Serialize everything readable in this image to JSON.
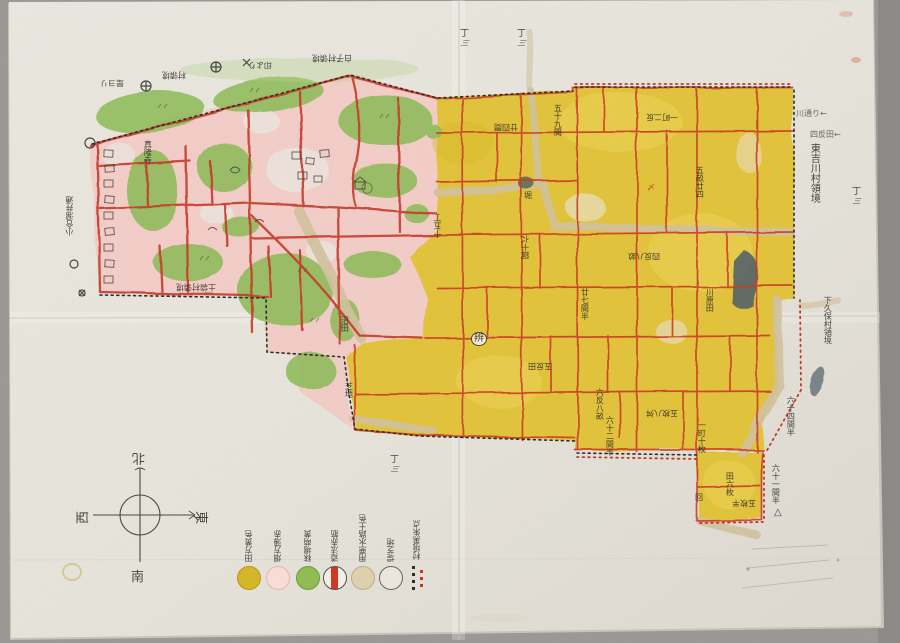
{
  "compass": {
    "north": "北",
    "south": "南",
    "east": "東",
    "west": "西"
  },
  "measure_mark": {
    "top": "丁",
    "bottom": "三"
  },
  "legend": {
    "entries": [
      {
        "name": "rice-field",
        "label": "田方黄色",
        "color": "#d4b62a"
      },
      {
        "name": "upland-field",
        "label": "畑方薄赤",
        "color": "#f7ddd6"
      },
      {
        "name": "meadow",
        "label": "秣場萌黄",
        "color": "#8fbc55"
      },
      {
        "name": "road",
        "label": "道法赤筋",
        "color": "#cf3a22"
      },
      {
        "name": "waterway",
        "label": "用悪水路土色",
        "color": "#ddd0ac"
      },
      {
        "name": "levee-grass",
        "label": "堤芝地",
        "color": "#f2efe7"
      },
      {
        "name": "boundary-marks",
        "label": "村境黒朱点",
        "colors": [
          "#2f2d28",
          "#c23a22"
        ]
      }
    ]
  },
  "labels": [
    {
      "text": "是ヨリ"
    },
    {
      "text": "村領境"
    },
    {
      "text": "印より"
    },
    {
      "text": "白子村領境"
    },
    {
      "text": "小合溜井通"
    },
    {
      "text": "土袋村領境"
    },
    {
      "text": "沼田"
    },
    {
      "text": "芝地"
    },
    {
      "text": "真隆寺"
    },
    {
      "text": "十五丁"
    },
    {
      "text": "東吉川村領境"
    },
    {
      "text": "下久保村領境"
    },
    {
      "text": "六十一間半"
    },
    {
      "text": "△"
    },
    {
      "text": "六十四間半"
    },
    {
      "text": "川通り←"
    },
    {
      "text": "四反田←"
    },
    {
      "text": "廿四間"
    },
    {
      "text": "五十九間"
    },
    {
      "text": "一町二反"
    },
    {
      "text": "五畝廿四"
    },
    {
      "text": "堀"
    },
    {
      "text": "六十間"
    },
    {
      "text": "四反八畝"
    },
    {
      "text": "廿七間半"
    },
    {
      "text": "川原田"
    },
    {
      "text": "辨"
    },
    {
      "text": "五反田"
    },
    {
      "text": "六反八畝"
    },
    {
      "text": "五枚八舛"
    },
    {
      "text": "六十二間半"
    },
    {
      "text": "一町十枚"
    },
    {
      "text": "田六枚"
    },
    {
      "text": "五枚半"
    },
    {
      "text": "回"
    },
    {
      "text": "〆"
    }
  ],
  "colors": {
    "paper": "#e9e6df",
    "field_yellow": "#e2c134",
    "village_pink": "#f3cbc6",
    "grove_green": "#8cba55",
    "road_red": "#c43a28",
    "path_tan": "#d2c29e",
    "water_dark": "#50606a",
    "ink": "#2d2b26"
  }
}
